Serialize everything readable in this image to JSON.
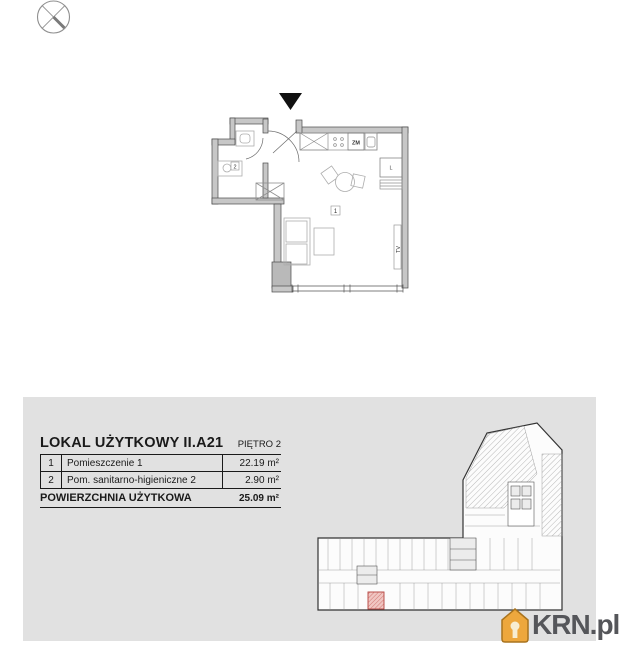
{
  "compass": {
    "icon": "north-compass"
  },
  "unit_plan": {
    "labels": {
      "room1": "1",
      "room2": "2",
      "dishwasher": "ZM",
      "fridge": "L",
      "tv": "TV"
    }
  },
  "info_panel": {
    "title": "LOKAL UŻYTKOWY II.A21",
    "floor": "PIĘTRO 2",
    "rows": [
      {
        "no": "1",
        "name": "Pomieszczenie 1",
        "area": "22.19 m²"
      },
      {
        "no": "2",
        "name": "Pom. sanitarno-higieniczne 2",
        "area": "2.90 m²"
      }
    ],
    "total_label": "POWIERZCHNIA UŻYTKOWA",
    "total_area": "25.09 m²"
  },
  "branding": {
    "logo": "KRN.pl"
  },
  "colors": {
    "panel_bg": "#e1e1e1",
    "wall_fill": "#c7c7c7",
    "plan_line": "#4a4a4a",
    "furniture_line": "#adadad",
    "highlight_fill": "#f0c6c2",
    "highlight_line": "#b3413c",
    "logo_orange": "#eda73d",
    "logo_text": "#55565a"
  }
}
